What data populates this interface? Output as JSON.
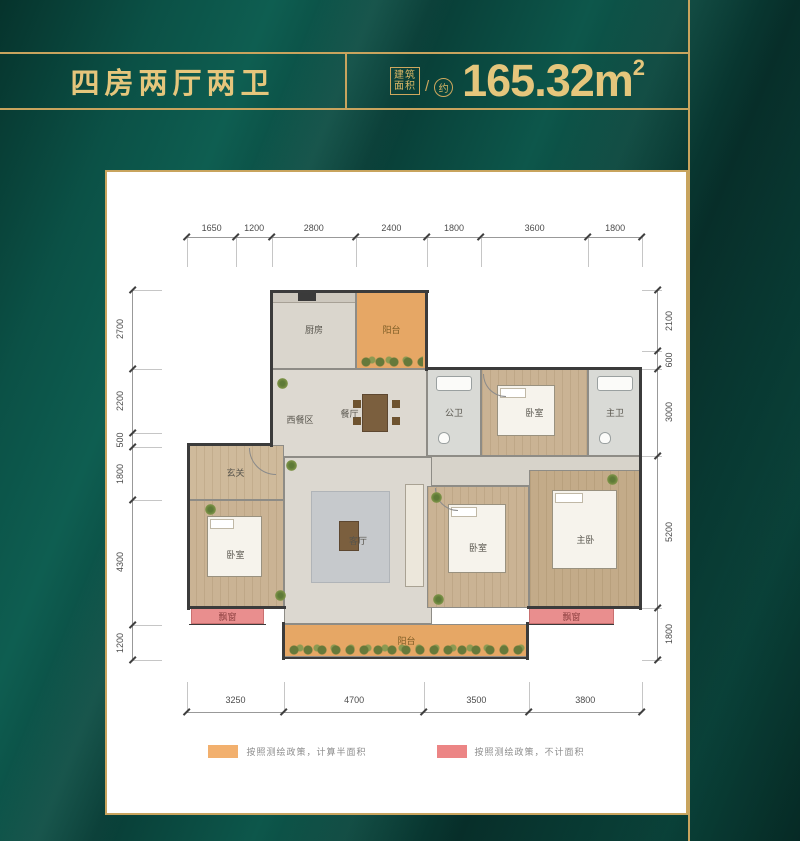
{
  "header": {
    "title": "四房两厅两卫",
    "area_label_line1": "建筑",
    "area_label_line2": "面积",
    "slash": "/",
    "area_approx": "约",
    "area_value": "165.32",
    "area_unit": "m",
    "area_sup": "2"
  },
  "colors": {
    "background_green": "#0a453c",
    "gold_accent": "#c8a45e",
    "gold_text": "#e5c67c",
    "panel_white": "#ffffff",
    "balcony_orange": "#e6a765",
    "bay_window_pink": "#e98e8e",
    "legend_orange": "#f2b06e",
    "legend_pink": "#ec8585"
  },
  "plan": {
    "dims": {
      "top": [
        1650,
        1200,
        2800,
        2400,
        1800,
        3600,
        1800
      ],
      "bottom": [
        3250,
        4700,
        3500,
        3800
      ],
      "left": [
        2700,
        2200,
        500,
        1800,
        4300,
        1200
      ],
      "right": [
        2100,
        600,
        3000,
        5200,
        1800
      ]
    },
    "rooms": [
      {
        "id": "kitchen",
        "label": "厨房",
        "x": 85,
        "y": 0,
        "w": 84,
        "h": 79,
        "fill": "#dad6cd",
        "furniture": "kitchen"
      },
      {
        "id": "balcony-top",
        "label": "阳台",
        "x": 169,
        "y": 0,
        "w": 71,
        "h": 79,
        "fill": "#e6a765",
        "labelColor": "#7d5d26",
        "plants": true
      },
      {
        "id": "dining",
        "label": "餐厅",
        "x": 85,
        "y": 79,
        "w": 155,
        "h": 88,
        "fill": "#ddd9d1",
        "furniture": "dining"
      },
      {
        "id": "public-bath",
        "label": "公卫",
        "x": 240,
        "y": 79,
        "w": 54,
        "h": 87,
        "fill": "#d9dad6",
        "furniture": "bath"
      },
      {
        "id": "bedroom-top",
        "label": "卧室",
        "x": 294,
        "y": 79,
        "w": 107,
        "h": 87,
        "fill": "#cab394",
        "floor": "wood",
        "furniture": "bed-h"
      },
      {
        "id": "master-bath",
        "label": "主卫",
        "x": 401,
        "y": 79,
        "w": 54,
        "h": 87,
        "fill": "#d9dad6",
        "furniture": "bath"
      },
      {
        "id": "corridor",
        "label": "",
        "x": 240,
        "y": 166,
        "w": 215,
        "h": 30,
        "fill": "#d7d3ca"
      },
      {
        "id": "foyer",
        "label": "玄关",
        "x": 0,
        "y": 155,
        "w": 97,
        "h": 55,
        "fill": "#cfba9b",
        "floor": "wood"
      },
      {
        "id": "bedroom-left",
        "label": "卧室",
        "x": 0,
        "y": 210,
        "w": 97,
        "h": 108,
        "fill": "#cab394",
        "floor": "wood",
        "furniture": "bed-v"
      },
      {
        "id": "living",
        "label": "客厅",
        "x": 97,
        "y": 167,
        "w": 148,
        "h": 167,
        "fill": "#dcd8d0",
        "furniture": "living"
      },
      {
        "id": "bedroom-mid",
        "label": "卧室",
        "x": 240,
        "y": 196,
        "w": 102,
        "h": 122,
        "fill": "#cab394",
        "floor": "wood",
        "furniture": "bed-v"
      },
      {
        "id": "master-bedroom",
        "label": "主卧",
        "x": 342,
        "y": 180,
        "w": 113,
        "h": 138,
        "fill": "#c3ab89",
        "floor": "wood",
        "furniture": "bed-v"
      },
      {
        "id": "bay-window-left",
        "label": "飘窗",
        "x": 4,
        "y": 318,
        "w": 73,
        "h": 16,
        "fill": "#e98e8e",
        "labelColor": "#8d4040",
        "border": "#c97070"
      },
      {
        "id": "balcony-bottom",
        "label": "阳台",
        "x": 97,
        "y": 334,
        "w": 245,
        "h": 33,
        "fill": "#e6a765",
        "labelColor": "#7d5d26",
        "plants": true
      },
      {
        "id": "bay-window-right",
        "label": "飘窗",
        "x": 342,
        "y": 318,
        "w": 85,
        "h": 16,
        "fill": "#e98e8e",
        "labelColor": "#8d4040",
        "border": "#c97070"
      },
      {
        "id": "west-dining-area",
        "label": "西餐区",
        "x": 88,
        "y": 117,
        "w": 50,
        "h": 24,
        "plain": true
      }
    ],
    "walls": [
      [
        83,
        0,
        159,
        3
      ],
      [
        83,
        0,
        3,
        81
      ],
      [
        238,
        0,
        3,
        81
      ],
      [
        238,
        77,
        217,
        3
      ],
      [
        452,
        77,
        3,
        243
      ],
      [
        83,
        77,
        3,
        80
      ],
      [
        0,
        153,
        85,
        3
      ],
      [
        0,
        153,
        3,
        167
      ],
      [
        0,
        316,
        99,
        3
      ],
      [
        340,
        316,
        115,
        3
      ],
      [
        95,
        332,
        3,
        38
      ],
      [
        339,
        332,
        3,
        38
      ],
      [
        95,
        367,
        247,
        2
      ],
      [
        2,
        334,
        77,
        1
      ],
      [
        342,
        334,
        85,
        1
      ]
    ],
    "doors": [
      {
        "x": 62,
        "y": 158,
        "s": 26
      },
      {
        "x": 296,
        "y": 84,
        "s": 22
      },
      {
        "x": 248,
        "y": 198,
        "s": 22
      }
    ],
    "plants": [
      [
        99,
        170
      ],
      [
        18,
        214
      ],
      [
        88,
        300
      ],
      [
        244,
        202
      ],
      [
        246,
        304
      ],
      [
        420,
        184
      ],
      [
        90,
        88
      ]
    ]
  },
  "legend": {
    "half_area": {
      "color": "#f2b06e",
      "text": "按照测绘政策，计算半面积"
    },
    "no_area": {
      "color": "#ec8585",
      "text": "按照测绘政策，不计面积"
    }
  }
}
